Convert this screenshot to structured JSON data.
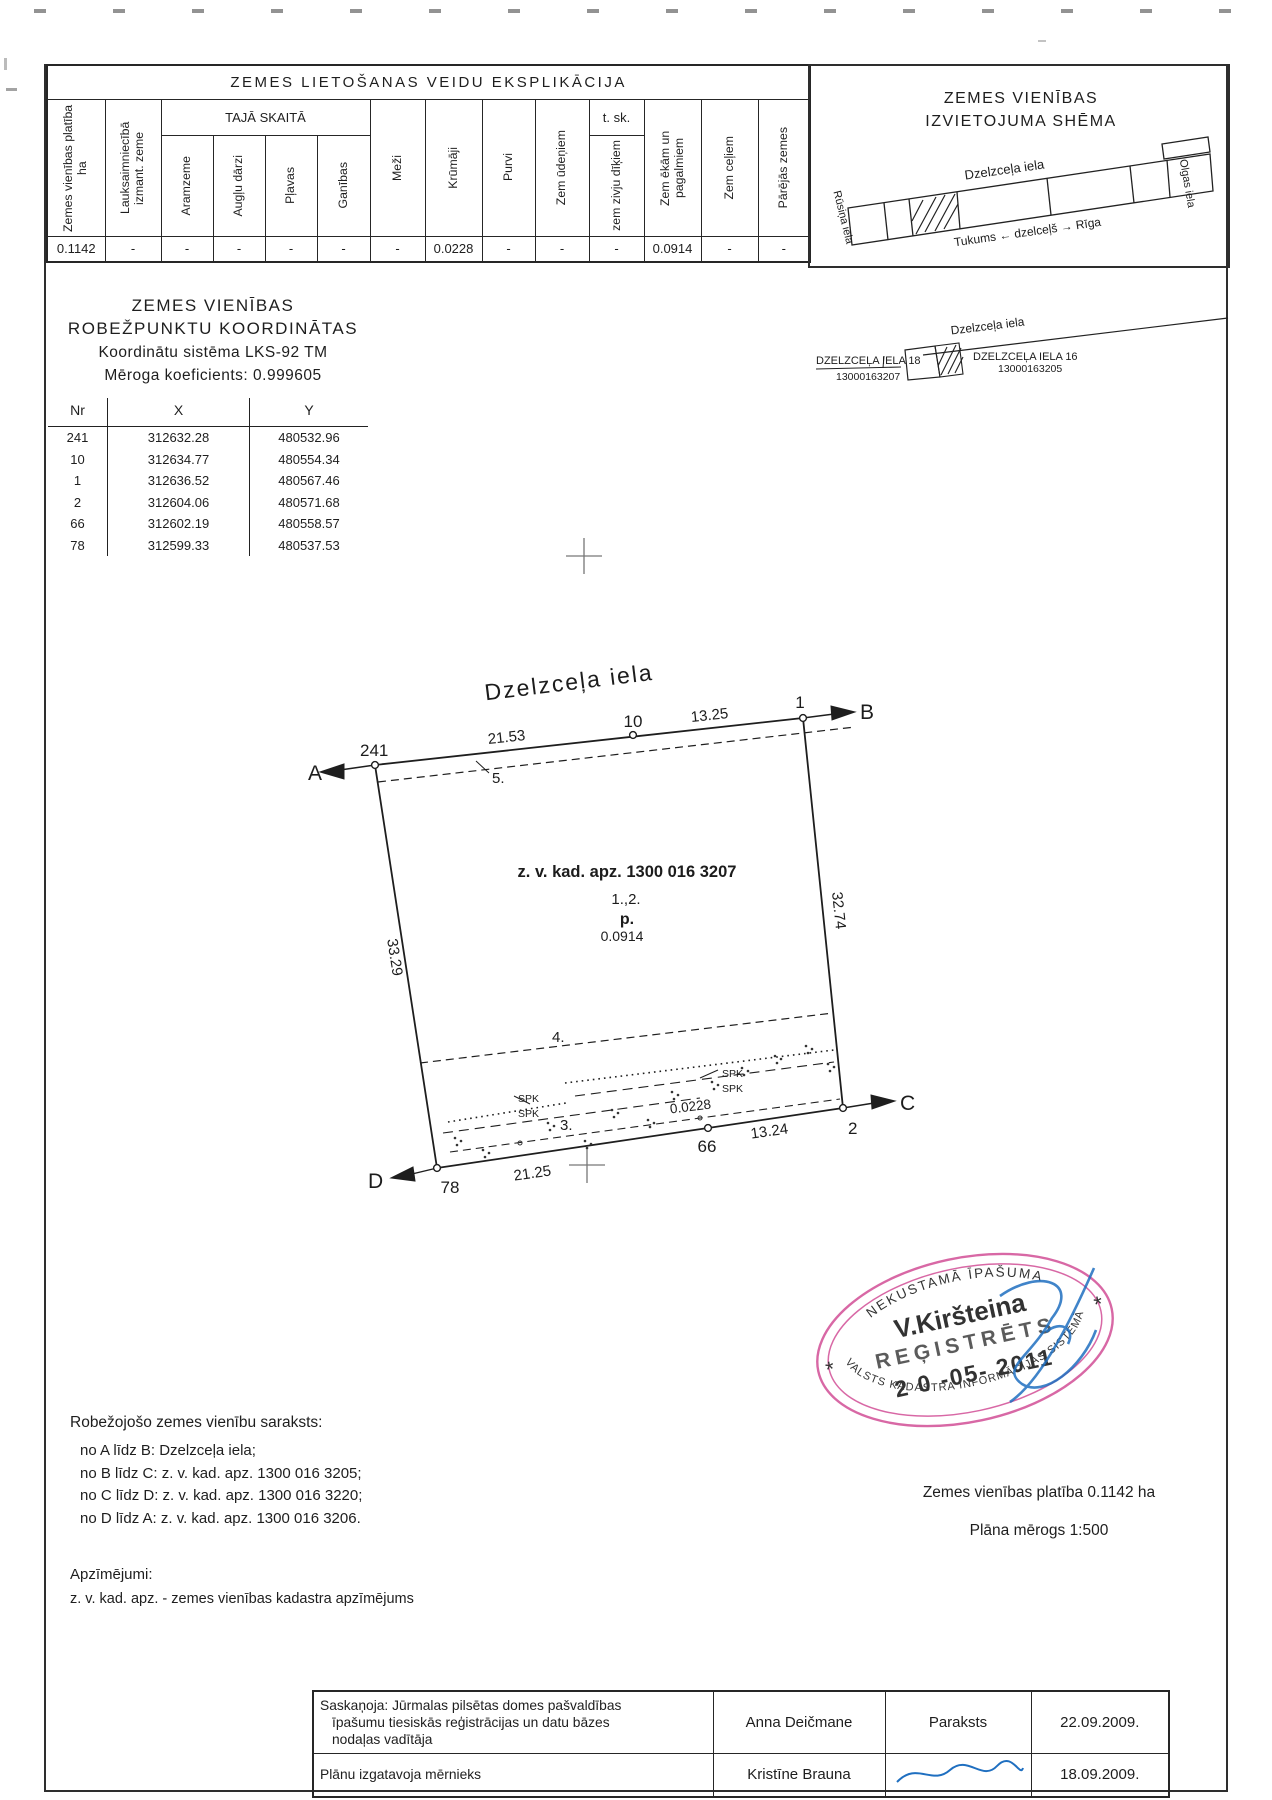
{
  "explication": {
    "title": "ZEMES LIETOŠANAS VEIDU EKSPLIKĀCIJA",
    "group_header": "TAJĀ SKAITĀ",
    "tsk_header": "t. sk.",
    "columns": [
      "Zemes vienības platība ha",
      "Lauksaimniecībā izmant. zeme",
      "Aramzeme",
      "Augļu dārzi",
      "Pļavas",
      "Ganības",
      "Meži",
      "Krūmāji",
      "Purvi",
      "Zem ūdeņiem",
      "zem zivju dīķiem",
      "Zem ēkām un pagalmiem",
      "Zem ceļiem",
      "Pārējās zemes"
    ],
    "values": [
      "0.1142",
      "-",
      "-",
      "-",
      "-",
      "-",
      "-",
      "0.0228",
      "-",
      "-",
      "-",
      "0.0914",
      "-",
      "-"
    ]
  },
  "location_scheme": {
    "title_line1": "ZEMES VIENĪBAS",
    "title_line2": "IZVIETOJUMA SHĒMA",
    "street": "Dzelzceļa iela",
    "left_street": "Rūsiņa iela",
    "right_street": "Olgas iela",
    "railway": "Tukums ← dzelceļš → Rīga"
  },
  "coordinates": {
    "title_line1": "ZEMES VIENĪBAS",
    "title_line2": "ROBEŽPUNKTU KOORDINĀTAS",
    "system_line": "Koordinātu sistēma LKS-92 TM",
    "scale_line": "Mēroga koeficients: 0.999605",
    "headers": [
      "Nr",
      "X",
      "Y"
    ],
    "rows": [
      [
        "241",
        "312632.28",
        "480532.96"
      ],
      [
        "10",
        "312634.77",
        "480554.34"
      ],
      [
        "1",
        "312636.52",
        "480567.46"
      ],
      [
        "2",
        "312604.06",
        "480571.68"
      ],
      [
        "66",
        "312602.19",
        "480558.57"
      ],
      [
        "78",
        "312599.33",
        "480537.53"
      ]
    ]
  },
  "detail_scheme": {
    "street": "Dzelzceļa iela",
    "left_parcel": "DZELZCEĻA IELA 18",
    "left_parcel_code": "13000163207",
    "right_parcel": "DZELZCEĻA IELA 16",
    "right_parcel_code": "13000163205"
  },
  "plan": {
    "street_title": "Dzelzceļa iela",
    "kadastral": "z. v. kad. apz. 1300 016 3207",
    "building_label": "1.,2.",
    "p_label": "p.",
    "building_area": "0.0914",
    "shrub_area": "0.0228",
    "zone_3": "3.",
    "zone_4": "4.",
    "zone_5": "5.",
    "spk": "SPK",
    "points": {
      "n241": "241",
      "n10": "10",
      "n1": "1",
      "n2": "2",
      "n66": "66",
      "n78": "78"
    },
    "corners": {
      "a": "A",
      "b": "B",
      "c": "C",
      "d": "D"
    },
    "dims": {
      "top_left": "21.53",
      "top_right": "13.25",
      "left": "33.29",
      "right": "32.74",
      "bottom_left": "21.25",
      "bottom_right": "13.24"
    }
  },
  "stamp": {
    "arc_top": "NEKUSTAMĀ ĪPAŠUMA",
    "name": "V.Kiršteina",
    "status": "REĢISTRĒTS",
    "date": "2 0 -05- 2011",
    "arc_bottom": "VALSTS KADASTRA INFORMĀCIJAS SISTĒMĀ",
    "star": "*",
    "colors": {
      "pink": "#d4589c",
      "blue": "#2a9fd4",
      "date_ink": "#4a3550",
      "signature": "#1f6fc0"
    }
  },
  "border_list": {
    "title": "Robežojošo zemes vienību saraksts:",
    "items": [
      "no A līdz B: Dzelzceļa iela;",
      "no B līdz C: z. v. kad. apz. 1300 016 3205;",
      "no C līdz D: z. v. kad. apz. 1300 016 3220;",
      "no D līdz A: z. v. kad. apz. 1300 016 3206."
    ]
  },
  "summary": {
    "area_line": "Zemes vienības platība 0.1142 ha",
    "scale_line": "Plāna mērogs 1:500"
  },
  "legend": {
    "title": "Apzīmējumi:",
    "item": "z. v. kad. apz.  -  zemes vienības kadastra apzīmējums"
  },
  "approval": {
    "row1": {
      "role_lines": [
        "Saskaņoja: Jūrmalas pilsētas domes pašvaldības",
        "īpašumu tiesiskās reģistrācijas un datu bāzes",
        "nodaļas vadītāja"
      ],
      "name": "Anna Deičmane",
      "signature": "Paraksts",
      "date": "22.09.2009."
    },
    "row2": {
      "role": "Plānu izgatavoja mērnieks",
      "name": "Kristīne Brauna",
      "date": "18.09.2009."
    }
  }
}
